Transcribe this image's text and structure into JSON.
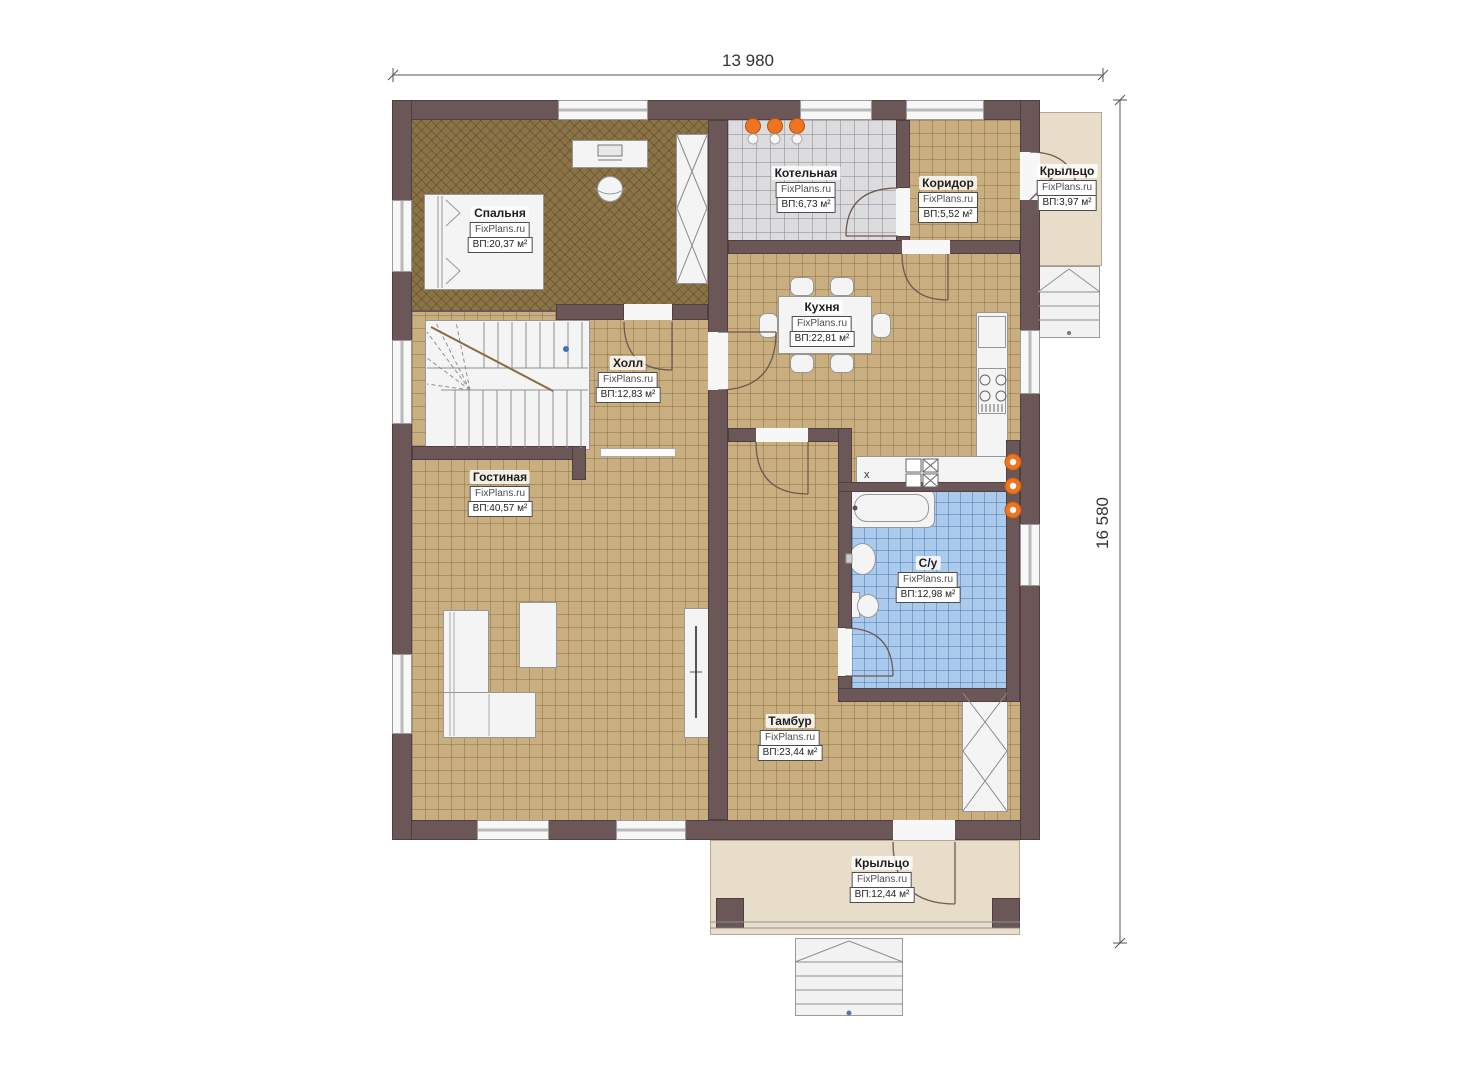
{
  "watermark": "FixPlans.ru",
  "dimensions": {
    "width": "13 980",
    "height": "16 580"
  },
  "symbols": {
    "sink": "x"
  },
  "rooms": [
    {
      "id": "bedroom",
      "name": "Спальня",
      "area": "ВП:20,37 м²"
    },
    {
      "id": "boiler",
      "name": "Котельная",
      "area": "ВП:6,73 м²"
    },
    {
      "id": "corridor",
      "name": "Коридор",
      "area": "ВП:5,52 м²"
    },
    {
      "id": "porch_right",
      "name": "Крыльцо",
      "area": "ВП:3,97 м²"
    },
    {
      "id": "kitchen",
      "name": "Кухня",
      "area": "ВП:22,81 м²"
    },
    {
      "id": "hall",
      "name": "Холл",
      "area": "ВП:12,83 м²"
    },
    {
      "id": "living",
      "name": "Гостиная",
      "area": "ВП:40,57 м²"
    },
    {
      "id": "bathroom",
      "name": "С/у",
      "area": "ВП:12,98 м²"
    },
    {
      "id": "vestibule",
      "name": "Тамбур",
      "area": "ВП:23,44 м²"
    },
    {
      "id": "porch_bottom",
      "name": "Крыльцо",
      "area": "ВП:12,44 м²"
    }
  ],
  "colors": {
    "wall": "#6b5758",
    "floor_tan": "#c9ae80",
    "carpet": "#8b7348",
    "tile_gray": "#dcdcde",
    "tile_blue": "#abcaec",
    "porch": "#e8ddc9",
    "accent_orange": "#ee7420"
  }
}
